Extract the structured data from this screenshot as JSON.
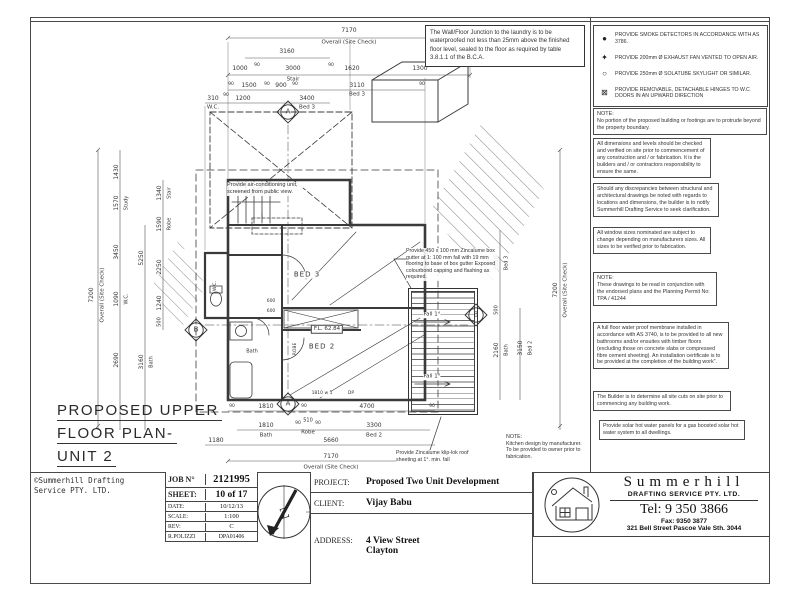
{
  "colors": {
    "line": "#3a3a3a",
    "text": "#222222",
    "paper": "#ffffff"
  },
  "waterproof_note": "The Wall/Floor Junction to the laundry is to be waterproofed not less than 25mm above the finished floor level, sealed to the floor as required by table 3.8.1.1 of the B.C.A.",
  "legend": {
    "items": [
      {
        "icon": "smoke-detector-icon",
        "glyph": "●",
        "text": "PROVIDE SMOKE DETECTORS IN ACCORDANCE WITH AS 3786."
      },
      {
        "icon": "exhaust-fan-icon",
        "glyph": "✦",
        "text": "PROVIDE 200mm Ø EXHAUST FAN VENTED TO OPEN AIR."
      },
      {
        "icon": "skylight-icon",
        "glyph": "○",
        "text": "PROVIDE 250mm Ø SOLATUBE SKYLIGHT OR SIMILAR."
      },
      {
        "icon": "hinge-icon",
        "glyph": "⊠",
        "text": "PROVIDE REMOVABLE, DETACHABLE HINGES TO W.C DOORS IN AN UPWARD DIRECTION"
      }
    ]
  },
  "notes": [
    {
      "title": "NOTE:",
      "body": "No portion of the proposed building or footings are to protrude beyond the property boundary."
    },
    {
      "body": "All dimensions and levels should be checked and verified on site prior to commencement of any construction and / or fabrication. It is the builders and / or contractors responsibility to ensure the same."
    },
    {
      "body": "Should any discrepancies between structural and architectural drawings be noted with regards to locations and dimensions, the builder is to notify Summerhill Drafting Service to seek clarification."
    },
    {
      "body": "All window sizes nominated are subject to change depending on manufacturers sizes. All sizes to be verified prior to fabrication."
    },
    {
      "title": "NOTE:",
      "body": "These drawings to be read in conjunction with the endorsed plans and the Planning Permit No: TPA / 41244"
    },
    {
      "body": "A full floor water proof membrane installed in accordance with AS 3740, is to be provided to all new bathrooms and/or ensuites with timber floors (excluding those on concrete slabs or compressed fibre cement sheeting). An installation certificate is to be provided at the completion of the building work\"."
    },
    {
      "body": "The Builder is to determine all site cuts on site prior to commencing any building work."
    },
    {
      "body": "Provide solar hot water panels for a gas boosted solar hot water system to all dwellings."
    }
  ],
  "plan_notes": {
    "ac": "Provide air-conditioning unit, screened from public view.",
    "gutter": "Provide 450 x 100 mm Zincalume box gutter at 1: 100 mm fall with 19 mm flooring to base of box gutter Exposed colourbond capping and flashing as required.",
    "roof": "Provide Zincalume klip-lok roof sheeting at 1°. min. fall",
    "kitchen_title": "NOTE:",
    "kitchen_body": "Kitchen design by manufacturer. To be provided to owner prior to fabrication."
  },
  "drawing_title": {
    "line1": "PROPOSED UPPER",
    "line2": "FLOOR PLAN-",
    "line3": "UNIT 2"
  },
  "copyright": {
    "line1": "©Summerhill Drafting",
    "line2": "Service PTY. LTD."
  },
  "title_block": {
    "job_label": "JOB N°",
    "job_value": "2121995",
    "sheet_label": "SHEET:",
    "sheet_value": "10 of 17",
    "date_label": "DATE:",
    "date_value": "10/12/13",
    "scale_label": "SCALE:",
    "scale_value": "1:100",
    "rev_label": "REV:",
    "rev_value": "C",
    "drafter": "R.POLIZZI",
    "drawing_no": "DPA01406",
    "project_label": "PROJECT:",
    "project_value": "Proposed Two Unit Development",
    "client_label": "CLIENT:",
    "client_value": "Vijay Babu",
    "address_label": "ADDRESS:",
    "address_line1": "4 View Street",
    "address_line2": "Clayton"
  },
  "firm": {
    "name": "Summerhill",
    "subtitle": "DRAFTING SERVICE PTY. LTD.",
    "tel": "Tel: 9 350 3866",
    "fax": "Fax: 9350 3877",
    "address": "321 Bell Street   Pascoe Vale Sth. 3044"
  },
  "plan": {
    "north_glyph": "Z",
    "labels": [
      {
        "t": "7170",
        "x": 349,
        "y": 31,
        "s": 6
      },
      {
        "t": "Overall (Site Check)",
        "x": 349,
        "y": 43,
        "s": 5.5
      },
      {
        "t": "3160",
        "x": 287,
        "y": 52,
        "s": 6
      },
      {
        "t": "1000",
        "x": 240,
        "y": 69,
        "s": 6
      },
      {
        "t": "90",
        "x": 257,
        "y": 66,
        "s": 4.5
      },
      {
        "t": "3000",
        "x": 293,
        "y": 69,
        "s": 6
      },
      {
        "t": "90",
        "x": 331,
        "y": 66,
        "s": 4.5
      },
      {
        "t": "1620",
        "x": 352,
        "y": 69,
        "s": 6
      },
      {
        "t": "1300",
        "x": 420,
        "y": 69,
        "s": 6
      },
      {
        "t": "Stair",
        "x": 293,
        "y": 80,
        "s": 5.5
      },
      {
        "t": "90",
        "x": 231,
        "y": 85,
        "s": 4.5
      },
      {
        "t": "1500",
        "x": 249,
        "y": 86,
        "s": 6
      },
      {
        "t": "90",
        "x": 267,
        "y": 85,
        "s": 4.5
      },
      {
        "t": "900",
        "x": 281,
        "y": 86,
        "s": 6
      },
      {
        "t": "90",
        "x": 295,
        "y": 85,
        "s": 4.5
      },
      {
        "t": "3110",
        "x": 357,
        "y": 86,
        "s": 6
      },
      {
        "t": "90",
        "x": 422,
        "y": 85,
        "s": 4.5
      },
      {
        "t": "Bed 3",
        "x": 357,
        "y": 95,
        "s": 5.5
      },
      {
        "t": "310",
        "x": 213,
        "y": 99,
        "s": 6
      },
      {
        "t": "90",
        "x": 226,
        "y": 96,
        "s": 4.5
      },
      {
        "t": "1200",
        "x": 243,
        "y": 99,
        "s": 6
      },
      {
        "t": "3400",
        "x": 307,
        "y": 99,
        "s": 6
      },
      {
        "t": "W.C.",
        "x": 213,
        "y": 108,
        "s": 5.5
      },
      {
        "t": "Bed 3",
        "x": 307,
        "y": 108,
        "s": 5.5
      },
      {
        "t": "7200",
        "x": 92,
        "y": 295,
        "r": -90,
        "s": 6
      },
      {
        "t": "Overall (Site Check)",
        "x": 103,
        "y": 295,
        "r": -90,
        "s": 5.5
      },
      {
        "t": "1430",
        "x": 117,
        "y": 172,
        "r": -90,
        "s": 6
      },
      {
        "t": "1570",
        "x": 117,
        "y": 203,
        "r": -90,
        "s": 6
      },
      {
        "t": "Study",
        "x": 127,
        "y": 203,
        "r": -90,
        "s": 5
      },
      {
        "t": "3450",
        "x": 117,
        "y": 252,
        "r": -90,
        "s": 6
      },
      {
        "t": "1090",
        "x": 117,
        "y": 299,
        "r": -90,
        "s": 6
      },
      {
        "t": "W.C.",
        "x": 127,
        "y": 299,
        "r": -90,
        "s": 5
      },
      {
        "t": "2690",
        "x": 117,
        "y": 360,
        "r": -90,
        "s": 6
      },
      {
        "t": "5250",
        "x": 142,
        "y": 258,
        "r": -90,
        "s": 6
      },
      {
        "t": "3160",
        "x": 142,
        "y": 362,
        "r": -90,
        "s": 6
      },
      {
        "t": "Bath",
        "x": 152,
        "y": 362,
        "r": -90,
        "s": 5
      },
      {
        "t": "1340",
        "x": 160,
        "y": 193,
        "r": -90,
        "s": 6
      },
      {
        "t": "Stair",
        "x": 170,
        "y": 193,
        "r": -90,
        "s": 5
      },
      {
        "t": "1590",
        "x": 160,
        "y": 224,
        "r": -90,
        "s": 6
      },
      {
        "t": "Robe",
        "x": 170,
        "y": 224,
        "r": -90,
        "s": 5
      },
      {
        "t": "2250",
        "x": 160,
        "y": 267,
        "r": -90,
        "s": 6
      },
      {
        "t": "1240",
        "x": 160,
        "y": 303,
        "r": -90,
        "s": 6
      },
      {
        "t": "500",
        "x": 160,
        "y": 322,
        "r": -90,
        "s": 5
      },
      {
        "t": "2650",
        "x": 497,
        "y": 263,
        "r": -90,
        "s": 6
      },
      {
        "t": "Bed 3",
        "x": 507,
        "y": 263,
        "r": -90,
        "s": 5
      },
      {
        "t": "500",
        "x": 497,
        "y": 310,
        "r": -90,
        "s": 5
      },
      {
        "t": "2160",
        "x": 497,
        "y": 350,
        "r": -90,
        "s": 6
      },
      {
        "t": "Bath",
        "x": 507,
        "y": 350,
        "r": -90,
        "s": 5
      },
      {
        "t": "3150",
        "x": 521,
        "y": 348,
        "r": -90,
        "s": 6
      },
      {
        "t": "Bed 2",
        "x": 531,
        "y": 348,
        "r": -90,
        "s": 5
      },
      {
        "t": "7200",
        "x": 556,
        "y": 290,
        "r": -90,
        "s": 6
      },
      {
        "t": "Overall (Site Check)",
        "x": 566,
        "y": 290,
        "r": -90,
        "s": 5.5
      },
      {
        "t": "90",
        "x": 232,
        "y": 407,
        "s": 4.5
      },
      {
        "t": "1810",
        "x": 266,
        "y": 407,
        "s": 6
      },
      {
        "t": "90",
        "x": 304,
        "y": 407,
        "s": 4.5
      },
      {
        "t": "4700",
        "x": 367,
        "y": 407,
        "s": 6
      },
      {
        "t": "90",
        "x": 432,
        "y": 407,
        "s": 4.5
      },
      {
        "t": "1810",
        "x": 266,
        "y": 426,
        "s": 6
      },
      {
        "t": "Bath",
        "x": 266,
        "y": 436,
        "s": 5.5
      },
      {
        "t": "90",
        "x": 298,
        "y": 424,
        "s": 4.5
      },
      {
        "t": "510",
        "x": 308,
        "y": 421,
        "s": 5
      },
      {
        "t": "90",
        "x": 318,
        "y": 424,
        "s": 4.5
      },
      {
        "t": "Robe",
        "x": 308,
        "y": 433,
        "s": 5.5
      },
      {
        "t": "3300",
        "x": 374,
        "y": 426,
        "s": 6
      },
      {
        "t": "Bed 2",
        "x": 374,
        "y": 436,
        "s": 5.5
      },
      {
        "t": "1180",
        "x": 216,
        "y": 441,
        "s": 6
      },
      {
        "t": "5660",
        "x": 331,
        "y": 441,
        "s": 6
      },
      {
        "t": "7170",
        "x": 331,
        "y": 457,
        "s": 6
      },
      {
        "t": "Overall (Site Check)",
        "x": 331,
        "y": 468,
        "s": 5.5
      },
      {
        "t": "A",
        "x": 288,
        "y": 112,
        "s": 7,
        "n": "section-marker-a"
      },
      {
        "t": "A",
        "x": 288,
        "y": 404,
        "s": 7,
        "n": "section-marker-a"
      },
      {
        "t": "B",
        "x": 196,
        "y": 330,
        "s": 7,
        "n": "section-marker-b"
      },
      {
        "t": "B",
        "x": 476,
        "y": 315,
        "s": 7,
        "n": "section-marker-b"
      },
      {
        "t": "BED 3",
        "x": 307,
        "y": 275,
        "s": 7,
        "ls": 1,
        "bg": 1,
        "n": "room-label-bed3"
      },
      {
        "t": "BED 2",
        "x": 322,
        "y": 347,
        "s": 7,
        "ls": 1,
        "bg": 1,
        "n": "room-label-bed2"
      },
      {
        "t": "ROBE",
        "x": 296,
        "y": 349,
        "r": -90,
        "s": 4.5,
        "n": "room-label-robe"
      },
      {
        "t": "Bath",
        "x": 252,
        "y": 352,
        "s": 5,
        "bg": 1,
        "n": "room-label-bath"
      },
      {
        "t": "W.C.",
        "x": 216,
        "y": 286,
        "r": -90,
        "s": 4.5,
        "n": "room-label-wc"
      },
      {
        "t": "F.L. 62.84",
        "x": 327,
        "y": 329,
        "s": 5.5,
        "b": 1,
        "n": "floor-level-label"
      },
      {
        "t": "600",
        "x": 271,
        "y": 302,
        "s": 4.5,
        "bg": 1
      },
      {
        "t": "600",
        "x": 271,
        "y": 312,
        "s": 4.5,
        "bg": 1
      },
      {
        "t": "1810 w 1",
        "x": 322,
        "y": 394,
        "s": 4.5,
        "bg": 1,
        "n": "window-tag"
      },
      {
        "t": "DP",
        "x": 351,
        "y": 394,
        "s": 4.5,
        "bg": 1,
        "n": "downpipe-tag"
      },
      {
        "t": "4150 w 1",
        "x": 430,
        "y": 262,
        "r": -90,
        "s": 4.5,
        "bg": 1,
        "n": "window-tag"
      },
      {
        "t": "Fall 1°",
        "x": 432,
        "y": 315,
        "s": 5.5,
        "bg": 1,
        "n": "fall-label"
      },
      {
        "t": "Fall 1°",
        "x": 432,
        "y": 377,
        "s": 5.5,
        "bg": 1,
        "n": "fall-label"
      }
    ]
  }
}
